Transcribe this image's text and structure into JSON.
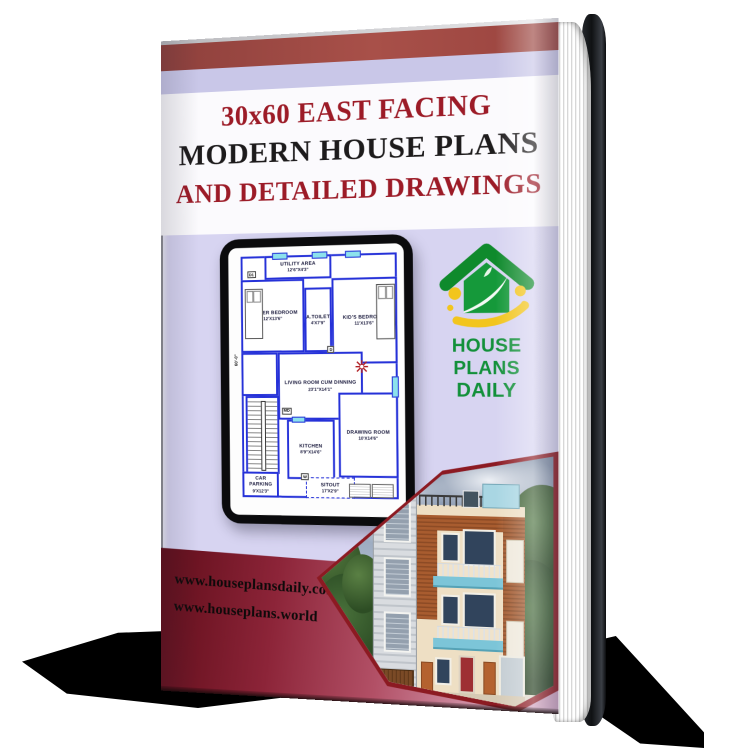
{
  "book": {
    "title_line1": "30x60 EAST FACING",
    "title_line2": "MODERN HOUSE PLANS",
    "title_line3": "AND DETAILED DRAWINGS",
    "website1": "www.houseplansdaily.com",
    "website2": "www.houseplans.world"
  },
  "logo": {
    "line1": "HOUSE PLANS",
    "line2": "DAILY"
  },
  "floor_plan": {
    "watermark_line1": "HOUSE PLANS",
    "watermark_line2": "DAILY",
    "side_dimension": "60'-0\"",
    "rooms": {
      "utility": {
        "label": "UTILITY AREA",
        "dims": "12'6\"X4'3\""
      },
      "master": {
        "label": "MASTER BEDROOM",
        "dims": "12'X13'6\""
      },
      "toilet": {
        "label": "A.TOILET",
        "dims": "4'X7'9\""
      },
      "kids": {
        "label": "KID'S BEDROOM",
        "dims": "11'X13'6\""
      },
      "living": {
        "label": "LIVING ROOM CUM DINNING",
        "dims": "23'1\"X14'1\""
      },
      "kitchen": {
        "label": "KITCHEN",
        "dims": "8'9\"X14'6\""
      },
      "drawing": {
        "label": "DRAWING ROOM",
        "dims": "10'X14'6\""
      },
      "sitout": {
        "label": "SITOUT",
        "dims": "17'X2'9\""
      },
      "parking": {
        "label": "CAR PARKING",
        "dims": "9'X12'3\""
      }
    },
    "door_marks": [
      "D1",
      "D",
      "MD",
      "W"
    ]
  },
  "colors": {
    "maroon_title": "#9c1b27",
    "black_title": "#1d1b1c",
    "lavender_bg": "#d7d4f1",
    "top_band_red": "#9a443f",
    "bottom_band_red": "#5e0c18",
    "brand_green": "#12903a",
    "accent_yellow": "#f2c51d",
    "plan_wall_blue": "#2531d8",
    "plan_window_aqua": "#8ce2ec",
    "hexagon_border": "#8c1a22"
  }
}
